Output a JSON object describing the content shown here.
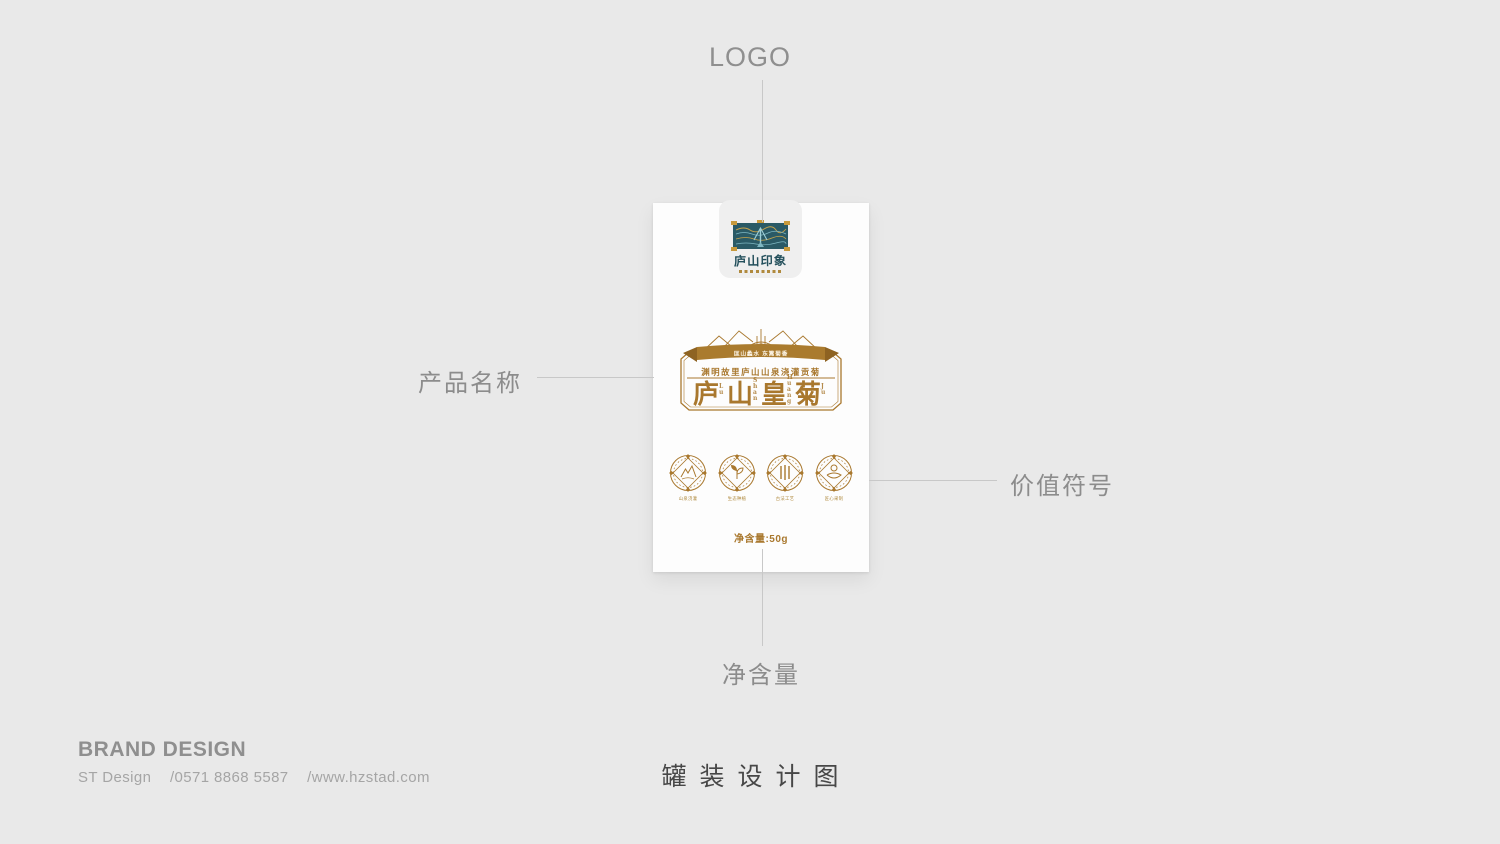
{
  "annotations": {
    "logo": "LOGO",
    "product_name": "产品名称",
    "value_symbols": "价值符号",
    "net_content": "净含量"
  },
  "footer": {
    "brand_title": "BRAND DESIGN",
    "studio": "ST Design",
    "phone": "/0571 8868 5587",
    "website": "/www.hzstad.com",
    "caption": "罐装设计图"
  },
  "package": {
    "logo": {
      "wordmark": "庐山印象",
      "emblem_name": "lushan-mountain-seal"
    },
    "label": {
      "ribbon_text": "匡山蠡水 东篱菊香",
      "subtitle": "渊明故里庐山山泉浇灌贡菊",
      "title": "庐山皇菊",
      "title_pinyin": [
        "Lu",
        "Shan",
        "Huang",
        "Ju"
      ]
    },
    "value_icons": [
      {
        "name": "mountain-spring-icon",
        "caption": "山泉浇灌"
      },
      {
        "name": "eco-sprout-icon",
        "caption": "生态种植"
      },
      {
        "name": "bamboo-craft-icon",
        "caption": "古法工艺"
      },
      {
        "name": "hand-picked-icon",
        "caption": "匠心采制"
      }
    ],
    "net_content": "净含量:50g"
  },
  "colors": {
    "gold": "#a9782e",
    "teal": "#2a5a66",
    "page_bg": "#e9e9e9",
    "annotation_gray": "#8c8c8c",
    "line_gray": "#c8c8c8"
  }
}
